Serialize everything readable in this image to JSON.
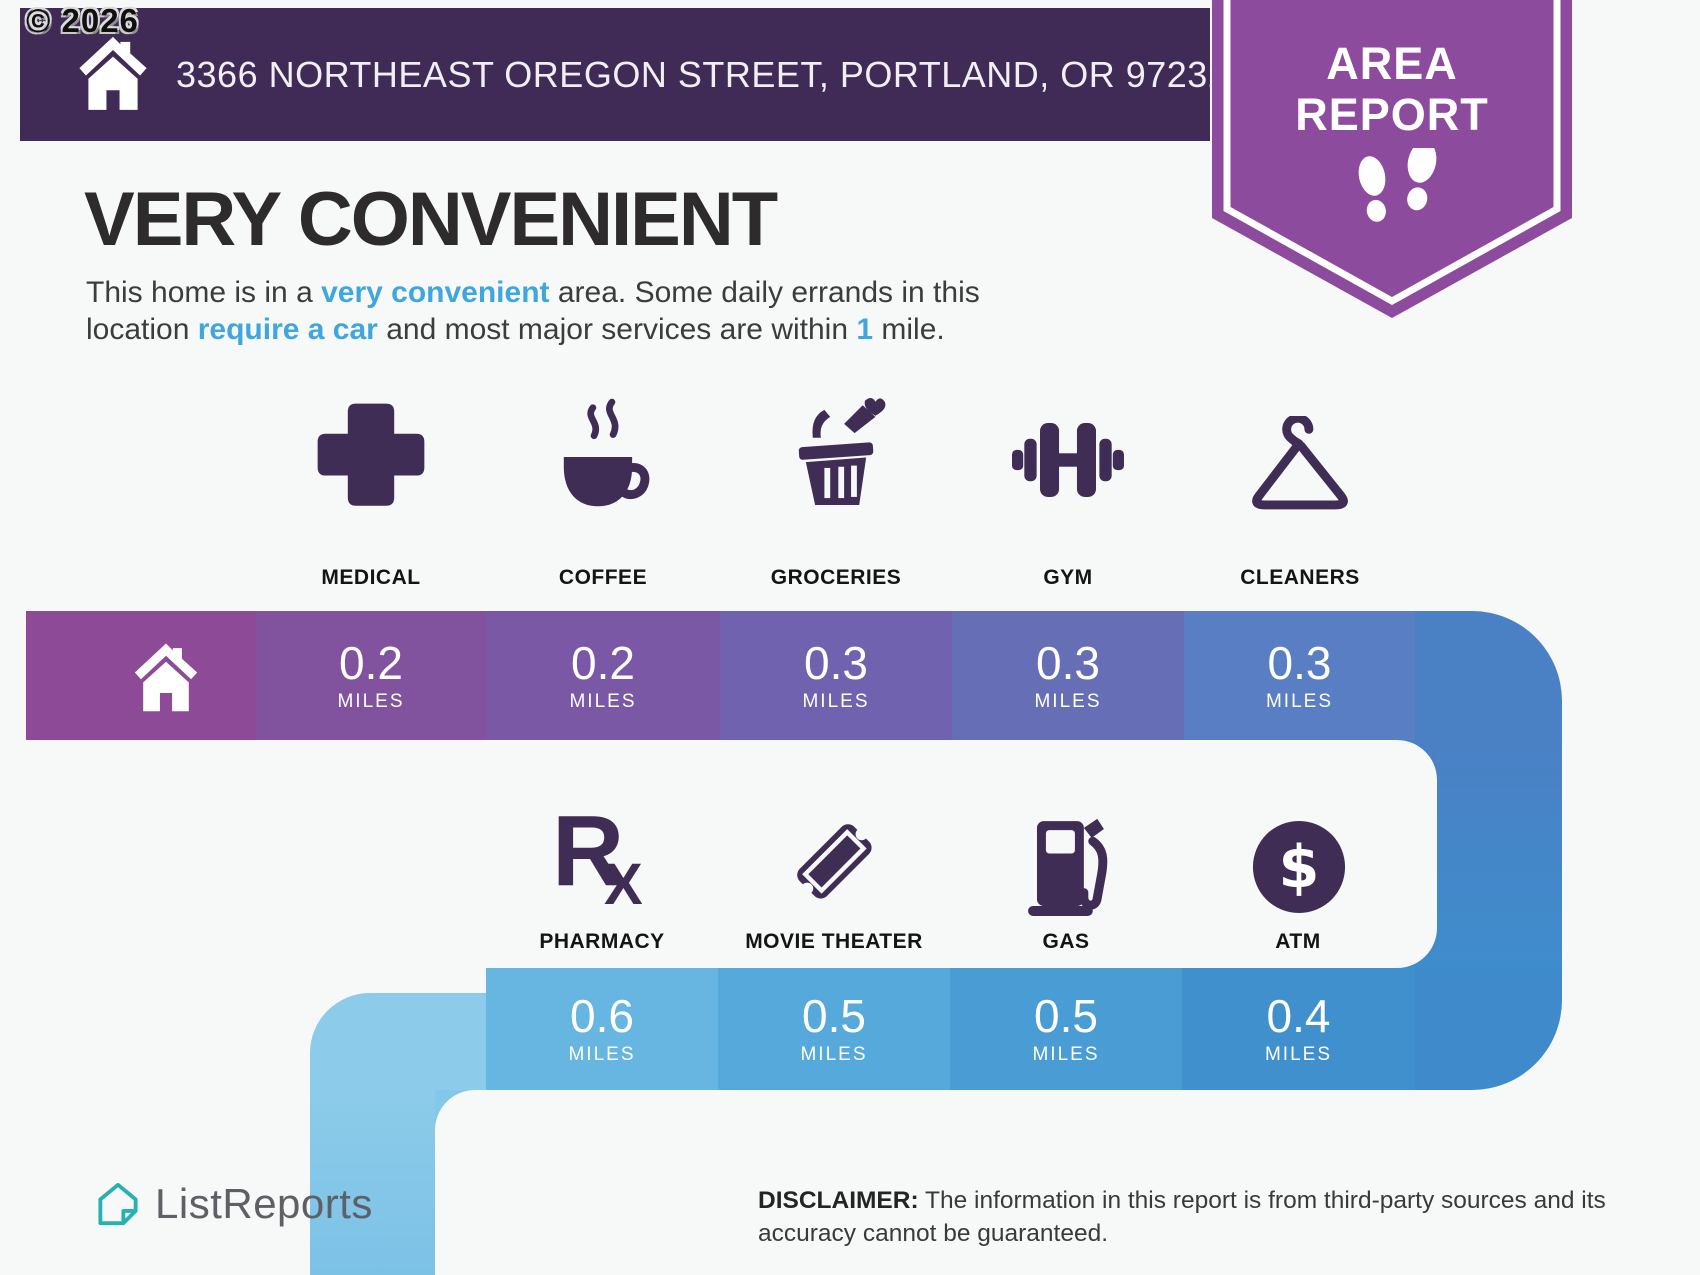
{
  "copyright": "© 2026",
  "header": {
    "address": "3366 NORTHEAST OREGON STREET, PORTLAND, OR 97232",
    "badge": {
      "line1": "AREA",
      "line2": "REPORT"
    }
  },
  "hero": {
    "title": "VERY CONVENIENT",
    "l1a": "This home is in a ",
    "l1b": "very convenient",
    "l1c": " area. Some daily errands in this",
    "l2a": "location ",
    "l2b": "require a car",
    "l2c": " and most major services are within ",
    "l2d": "1",
    "l2e": " mile."
  },
  "row1": {
    "items": [
      {
        "label": "MEDICAL",
        "value": "0.2",
        "unit": "MILES",
        "icon": "medical-cross-icon"
      },
      {
        "label": "COFFEE",
        "value": "0.2",
        "unit": "MILES",
        "icon": "coffee-cup-icon"
      },
      {
        "label": "GROCERIES",
        "value": "0.3",
        "unit": "MILES",
        "icon": "grocery-basket-icon"
      },
      {
        "label": "GYM",
        "value": "0.3",
        "unit": "MILES",
        "icon": "dumbbell-icon"
      },
      {
        "label": "CLEANERS",
        "value": "0.3",
        "unit": "MILES",
        "icon": "hanger-icon"
      }
    ]
  },
  "row2": {
    "items": [
      {
        "label": "PHARMACY",
        "value": "0.6",
        "unit": "MILES",
        "icon": "rx-icon"
      },
      {
        "label": "MOVIE THEATER",
        "value": "0.5",
        "unit": "MILES",
        "icon": "ticket-icon"
      },
      {
        "label": "GAS",
        "value": "0.5",
        "unit": "MILES",
        "icon": "gas-pump-icon"
      },
      {
        "label": "ATM",
        "value": "0.4",
        "unit": "MILES",
        "icon": "dollar-circle-icon"
      }
    ],
    "rx_r": "R",
    "rx_x": "X",
    "atm_symbol": "$"
  },
  "footer": {
    "brand": "ListReports",
    "disclaimer_label": "DISCLAIMER:",
    "disclaimer_line1": " The information in this report is from third-party sources and its",
    "disclaimer_line2": "accuracy cannot be guaranteed."
  },
  "colors": {
    "header_bg": "#3f2b56",
    "badge_purple": "#8d4b9e",
    "icon_purple": "#3f2d56",
    "highlight_blue": "#3fa7de",
    "band1_cells": [
      "#8d4a96",
      "#81539f",
      "#7a58a6",
      "#7062ae",
      "#666fb6",
      "#597ec3",
      "#4a81c5"
    ],
    "band2_cells": [
      "#8ccbe9",
      "#67b6e2",
      "#56aadb",
      "#4a9cd4",
      "#4090ce",
      "#3e8acb"
    ],
    "brand_teal": "#26b2b1",
    "background": "#f7f8f8"
  }
}
